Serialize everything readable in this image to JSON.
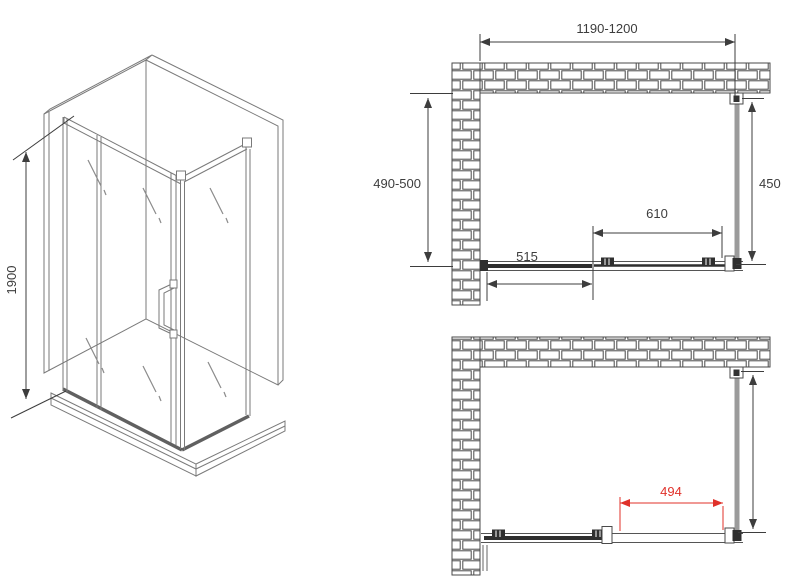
{
  "drawing": {
    "colors": {
      "line": "#444444",
      "iso_line": "#7a7a7a",
      "dim": "#3d3d3d",
      "brick": "#4a4a4a",
      "dark": "#2f2f2f",
      "panel_gray": "#9b9b9b",
      "red": "#e0312a"
    },
    "isometric_view": {
      "height_label": "1900"
    },
    "plan_closed": {
      "overall_width_label": "1190-1200",
      "depth_label": "490-500",
      "side_panel_label": "450",
      "door_panel_label": "610",
      "fixed_panel_label": "515"
    },
    "plan_open": {
      "opening_label": "494"
    }
  }
}
